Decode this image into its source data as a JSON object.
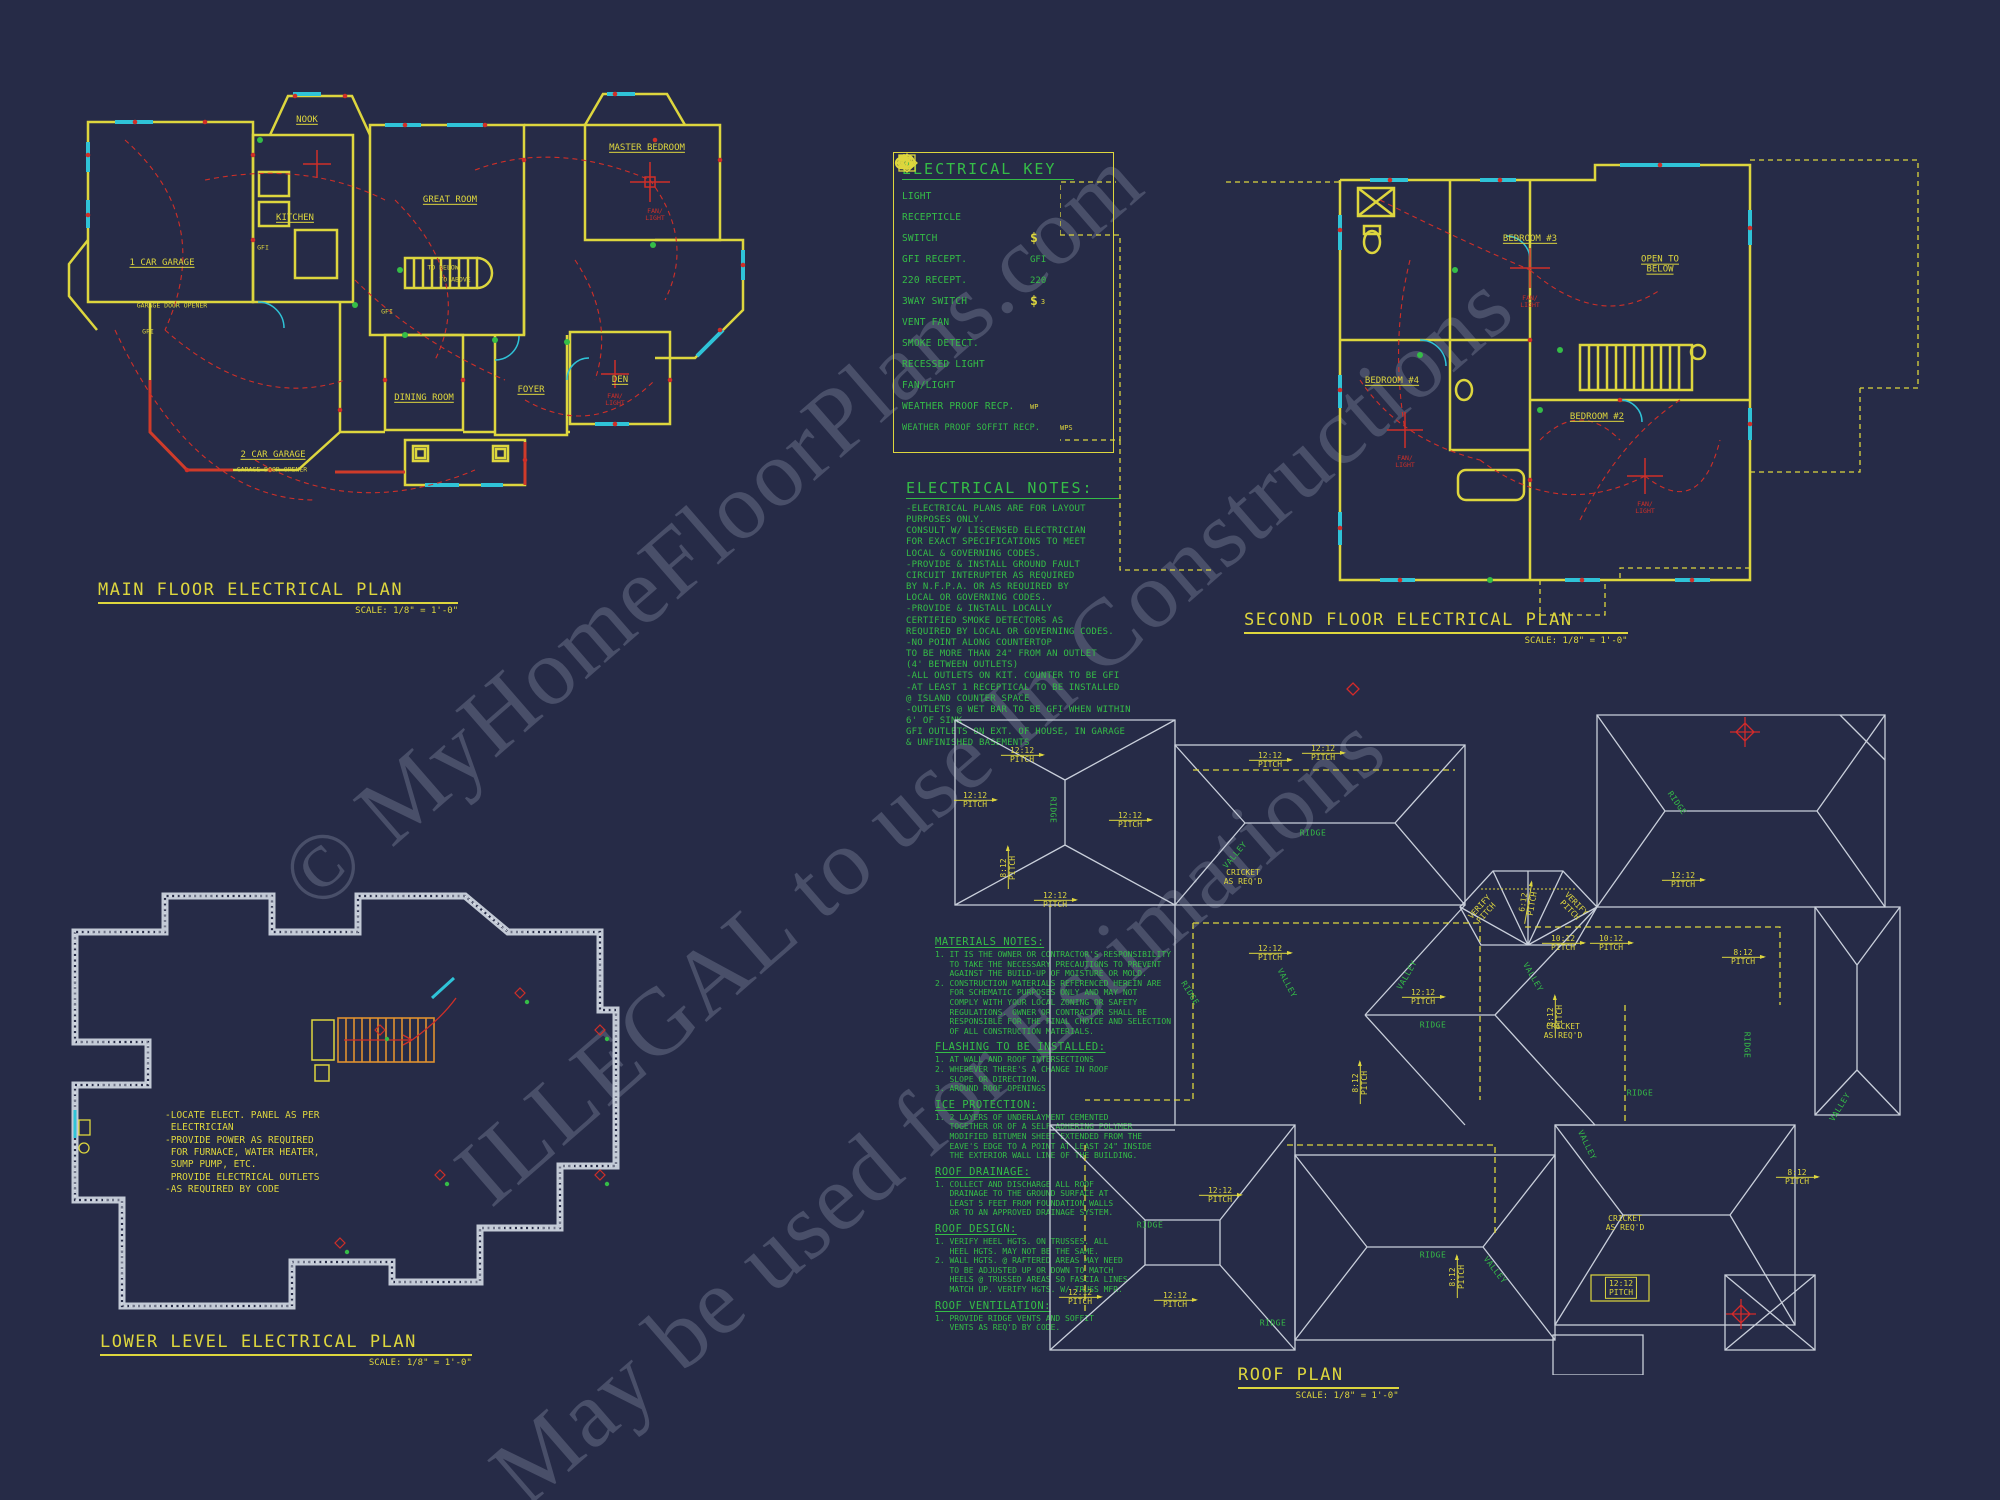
{
  "watermark": {
    "line1": "© MyHomeFloorPlans.com",
    "line2": "ILLEGAL to use In Constructions",
    "line3": "May be used for Estimations"
  },
  "palette": {
    "background": "#262b47",
    "wall_yellow": "#ddd63e",
    "window_cyan": "#2fc3d7",
    "wiring_red": "#cf2f28",
    "notes_green": "#35bd47",
    "roof_white": "#c9cfdb"
  },
  "key": {
    "title": "ELECTRICAL KEY",
    "symbols": {
      "switch_glyph": "$",
      "three_way_sub": "3",
      "smoke_letter": "S"
    },
    "items": [
      {
        "label": "LIGHT",
        "symbol": "light-icon",
        "suffix": ""
      },
      {
        "label": "RECEPTICLE",
        "symbol": "receptacle-icon",
        "suffix": ""
      },
      {
        "label": "SWITCH",
        "symbol": "switch-icon",
        "suffix": ""
      },
      {
        "label": "GFI RECEPT.",
        "symbol": "gfi-receptacle-icon",
        "suffix": "GFI"
      },
      {
        "label": "220 RECEPT.",
        "symbol": "220-receptacle-icon",
        "suffix": "220"
      },
      {
        "label": "3WAY SWITCH",
        "symbol": "three-way-switch-icon",
        "suffix": ""
      },
      {
        "label": "VENT FAN",
        "symbol": "vent-fan-icon",
        "suffix": ""
      },
      {
        "label": "SMOKE DETECT.",
        "symbol": "smoke-detector-icon",
        "suffix": ""
      },
      {
        "label": "RECESSED LIGHT",
        "symbol": "recessed-light-icon",
        "suffix": ""
      },
      {
        "label": "FAN/LIGHT",
        "symbol": "fan-light-icon",
        "suffix": ""
      },
      {
        "label": "WEATHER PROOF RECP.",
        "symbol": "weather-proof-receptacle-icon",
        "suffix": "WP"
      },
      {
        "label": "WEATHER PROOF SOFFIT RECP.",
        "symbol": "weather-proof-soffit-receptacle-icon",
        "suffix": "WPS"
      }
    ]
  },
  "electrical_notes": {
    "title": "ELECTRICAL NOTES:",
    "body": "-ELECTRICAL PLANS ARE FOR LAYOUT\nPURPOSES ONLY.\nCONSULT W/ LISCENSED ELECTRICIAN\nFOR EXACT SPECIFICATIONS TO MEET\nLOCAL & GOVERNING CODES.\n-PROVIDE & INSTALL GROUND FAULT\nCIRCUIT INTERUPTER AS REQUIRED\nBY N.F.P.A. OR AS REQUIRED BY\nLOCAL OR GOVERNING CODES.\n-PROVIDE & INSTALL LOCALLY\nCERTIFIED SMOKE DETECTORS AS\nREQUIRED BY LOCAL OR GOVERNING CODES.\n-NO POINT ALONG COUNTERTOP\nTO BE MORE THAN 24\" FROM AN OUTLET\n(4' BETWEEN OUTLETS)\n-ALL OUTLETS ON KIT. COUNTER TO BE GFI\n-AT LEAST 1 RECEPTICAL TO BE INSTALLED\n@ ISLAND COUNTER SPACE\n-OUTLETS @ WET BAR TO BE GFI WHEN WITHIN\n6' OF SINK\nGFI OUTLETS ON EXT. OF HOUSE, IN GARAGE\n& UNFINISHED BASEMENTS"
  },
  "materials_notes": {
    "sections": [
      {
        "heading": "MATERIALS NOTES:",
        "body": "1. IT IS THE OWNER OR CONTRACTOR'S RESPONSIBILITY\n   TO TAKE THE NECESSARY PRECAUTIONS TO PREVENT\n   AGAINST THE BUILD-UP OF MOISTURE OR MOLD.\n2. CONSTRUCTION MATERIALS REFERENCED HEREIN ARE\n   FOR SCHEMATIC PURPOSES ONLY AND MAY NOT\n   COMPLY WITH YOUR LOCAL ZONING OR SAFETY\n   REGULATIONS. OWNER OR CONTRACTOR SHALL BE\n   RESPONSIBLE FOR THE FINAL CHOICE AND SELECTION\n   OF ALL CONSTRUCTION MATERIALS."
      },
      {
        "heading": "FLASHING TO BE INSTALLED:",
        "body": "1. AT WALL AND ROOF INTERSECTIONS\n2. WHEREVER THERE'S A CHANGE IN ROOF\n   SLOPE OR DIRECTION.\n3. AROUND ROOF OPENINGS"
      },
      {
        "heading": "ICE PROTECTION:",
        "body": "1. 2 LAYERS OF UNDERLAYMENT CEMENTED\n   TOGETHER OR OF A SELF-ADHERING POLYMER\n   MODIFIED BITUMEN SHEET EXTENDED FROM THE\n   EAVE'S EDGE TO A POINT AT LEAST 24\" INSIDE\n   THE EXTERIOR WALL LINE OF THE BUILDING."
      },
      {
        "heading": "ROOF DRAINAGE:",
        "body": "1. COLLECT AND DISCHARGE ALL ROOF\n   DRAINAGE TO THE GROUND SURFACE AT\n   LEAST 5 FEET FROM FOUNDATION WALLS\n   OR TO AN APPROVED DRAINAGE SYSTEM."
      },
      {
        "heading": "ROOF DESIGN:",
        "body": "1. VERIFY HEEL HGTS. ON TRUSSES. ALL\n   HEEL HGTS. MAY NOT BE THE SAME.\n2. WALL HGTS. @ RAFTERED AREAS MAY NEED\n   TO BE ADJUSTED UP OR DOWN TO MATCH\n   HEELS @ TRUSSED AREAS SO FASCIA LINES\n   MATCH UP. VERIFY HGTS. W/ TRUSS MFR."
      },
      {
        "heading": "ROOF VENTILATION:",
        "body": "1. PROVIDE RIDGE VENTS AND SOFFIT\n   VENTS AS REQ'D BY CODE."
      }
    ]
  },
  "plans": {
    "main": {
      "title": "MAIN FLOOR ELECTRICAL PLAN",
      "scale": "SCALE: 1/8\" = 1'-0\"",
      "rooms": {
        "garage1": "1 CAR GARAGE",
        "garage2": "2 CAR GARAGE",
        "garage_door_opener": "GARAGE DOOR OPENER",
        "nook": "NOOK",
        "great_room": "GREAT ROOM",
        "master_bedroom": "MASTER BEDROOM",
        "kitchen": "KITCHEN",
        "dining": "DINING ROOM",
        "foyer": "FOYER",
        "den": "DEN",
        "to_below": "TO BELOW",
        "to_above": "TO ABOVE",
        "gfi": "GFI",
        "fan_light": "FAN/\nLIGHT"
      }
    },
    "second": {
      "title": "SECOND FLOOR ELECTRICAL PLAN",
      "scale": "SCALE: 1/8\" = 1'-0\"",
      "rooms": {
        "bedroom2": "BEDROOM #2",
        "bedroom3": "BEDROOM #3",
        "bedroom4": "BEDROOM #4",
        "open_below": "OPEN TO\nBELOW",
        "fan_light": "FAN/\nLIGHT"
      }
    },
    "lower": {
      "title": "LOWER LEVEL ELECTRICAL PLAN",
      "scale": "SCALE: 1/8\" = 1'-0\"",
      "notes": "-LOCATE ELECT. PANEL AS PER\n ELECTRICIAN\n-PROVIDE POWER AS REQUIRED\n FOR FURNACE, WATER HEATER,\n SUMP PUMP, ETC.\n PROVIDE ELECTRICAL OUTLETS\n-AS REQUIRED BY CODE"
    },
    "roof": {
      "title": "ROOF PLAN",
      "scale": "SCALE: 1/8\" = 1'-0\"",
      "labels": {
        "pitch_12": "12:12",
        "pitch_8": "8:12",
        "pitch_10": "10:12",
        "pitch_6": "6:12",
        "pitch_word": "PITCH",
        "ridge": "RIDGE",
        "valley": "VALLEY",
        "cricket": "CRICKET\nAS REQ'D",
        "verify_pitch": "VERIFY\nPITCH"
      }
    }
  }
}
